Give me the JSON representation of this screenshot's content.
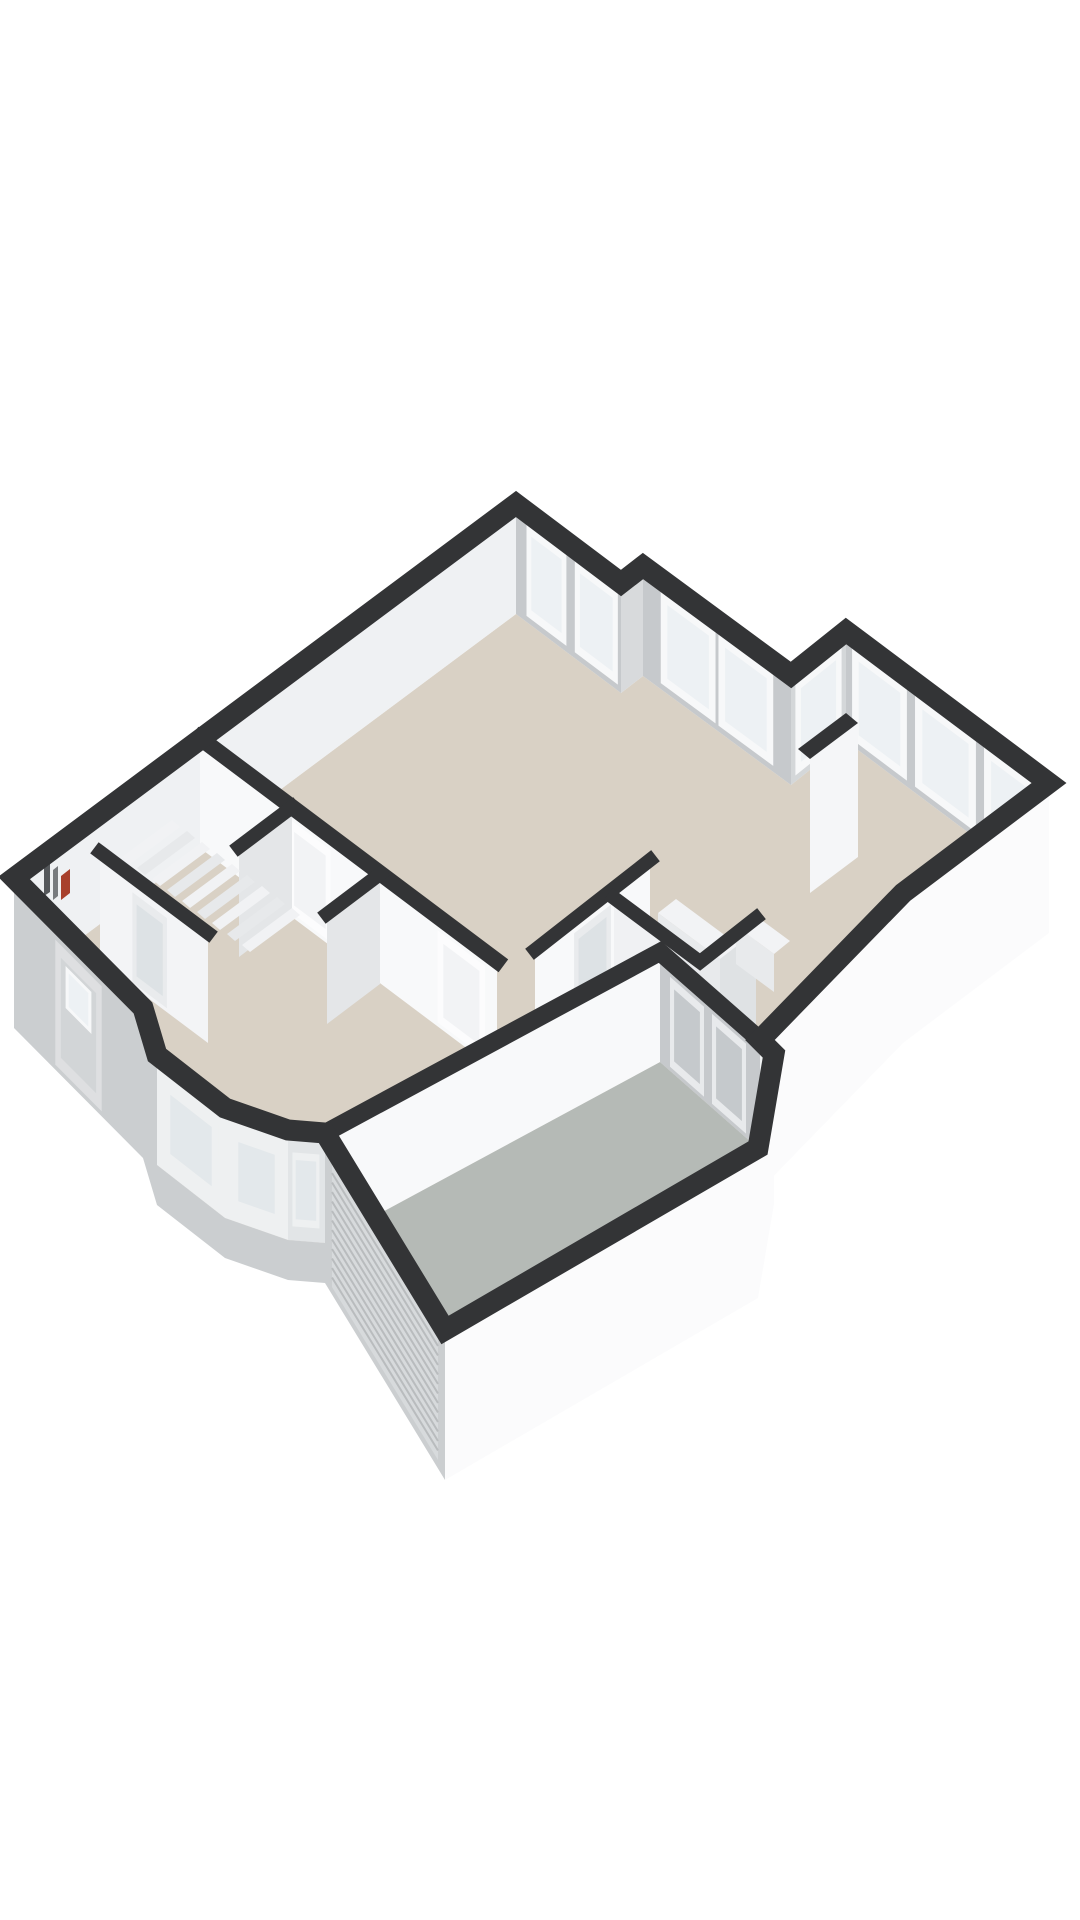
{
  "meta": {
    "canvas_width": 1080,
    "canvas_height": 1920,
    "description_name": "isometric-3d-floorplan-render"
  },
  "colors": {
    "bg": "#ffffff",
    "cap": "#333436",
    "floor_beige": "#d9d1c5",
    "floor_gray": "#b5bab6",
    "inner_light": "#eff1f3",
    "inner_gray": "#c6c9cc",
    "inner_mid": "#d8dadc",
    "wing_end": "#d4d7d9",
    "ext_bright": "#fbfbfc",
    "ext_gray": "#cbced0",
    "ext_step": "#eff1f2",
    "wall_bright": "#f8f9fa",
    "wall_soft": "#f3f4f6",
    "wall_return": "#e4e6e8",
    "wall_shade": "#dfe2e4",
    "wall_midtone": "#f0f1f3",
    "frame_white": "#f7f8f9",
    "glass": "#edf1f4",
    "glass_dim": "#e3e8eb",
    "bay_frame": "#eef0f1",
    "bay_glass": "#e2e5e7",
    "door_leaf": "#dedfe1",
    "door_panel": "#d2d5d7",
    "door_gray_frame": "#e8eaec",
    "door_gray": "#c5c9cc",
    "glazed_frame": "#e9ebed",
    "glazed_glass": "#dde2e5",
    "white_door": "#fcfcfd",
    "white_door_panel": "#f2f3f5",
    "tread_a": "#f1f2f4",
    "tread_b": "#e7e9eb",
    "chimney": "#f5f6f8",
    "box_top": "#f2f3f5",
    "box_face": "#e8eaec",
    "roller": "#d7dadc",
    "roller_line": "#b9bcbe",
    "heater_red": "#a8402c",
    "meter_dark": "#55585b",
    "meter_mid": "#787b7e"
  },
  "floorplan": {
    "shapes": [
      {
        "name": "floor-main-beige",
        "kind": "polygon",
        "fill": "$floor_beige",
        "points": "516,614 621,693 643,676 791,785 846,741 1049,893 903,1003 760,1150 660,1062 325,1243 288,1240 225,1218 157,1165 143,1118 14,988"
      },
      {
        "name": "floor-garage-gray",
        "kind": "polygon",
        "fill": "$floor_gray",
        "points": "325,1243 660,1062 760,1150 758,1258 445,1440"
      },
      {
        "name": "wall-nw-facade-inner-face",
        "kind": "polygon",
        "fill": "$inner_light",
        "points": "516,504 14,878 14,988 516,614"
      },
      {
        "name": "wall-ne-living-inner-face",
        "kind": "polygon",
        "fill": "$inner_gray",
        "points": "516,504 621,583 621,693 516,614"
      },
      {
        "name": "window-living-1",
        "kind": "window",
        "wall": [
          516,
          504,
          621,
          583
        ],
        "a": 0.1,
        "b": 0.48,
        "t": 12,
        "m": 104,
        "frame": "$frame_white",
        "glass": "$glass"
      },
      {
        "name": "window-living-2",
        "kind": "window",
        "wall": [
          516,
          504,
          621,
          583
        ],
        "a": 0.56,
        "b": 0.97,
        "t": 12,
        "m": 104,
        "frame": "$frame_white",
        "glass": "$glass"
      },
      {
        "name": "wall-notch-face",
        "kind": "polygon",
        "fill": "$inner_mid",
        "points": "621,583 643,566 643,676 621,693"
      },
      {
        "name": "wall-french-facade-face",
        "kind": "polygon",
        "fill": "$inner_gray",
        "points": "643,566 791,675 791,785 643,676"
      },
      {
        "name": "window-french-door-left",
        "kind": "window",
        "wall": [
          643,
          566,
          791,
          675
        ],
        "a": 0.12,
        "b": 0.49,
        "t": 12,
        "m": 104,
        "frame": "$frame_white",
        "glass": "$glass"
      },
      {
        "name": "window-french-door-right",
        "kind": "window",
        "wall": [
          643,
          566,
          791,
          675
        ],
        "a": 0.51,
        "b": 0.88,
        "t": 12,
        "m": 104,
        "frame": "$frame_white",
        "glass": "$glass"
      },
      {
        "name": "wall-wing-nw-end-face",
        "kind": "polygon",
        "fill": "$wing_end",
        "points": "791,675 846,631 846,741 791,785"
      },
      {
        "name": "window-wing-end",
        "kind": "window",
        "wall": [
          791,
          675,
          846,
          631
        ],
        "a": 0.08,
        "b": 0.92,
        "t": 12,
        "m": 104,
        "frame": "$frame_white",
        "glass": "$glass"
      },
      {
        "name": "wall-wing-ne-facade-face",
        "kind": "polygon",
        "fill": "$inner_gray",
        "points": "846,631 1049,783 1049,893 846,741"
      },
      {
        "name": "window-wing-1",
        "kind": "window",
        "wall": [
          846,
          631,
          1049,
          783
        ],
        "a": 0.03,
        "b": 0.3,
        "t": 12,
        "m": 104,
        "frame": "$frame_white",
        "glass": "$glass"
      },
      {
        "name": "window-wing-french",
        "kind": "window",
        "wall": [
          846,
          631,
          1049,
          783
        ],
        "a": 0.34,
        "b": 0.64,
        "t": 12,
        "m": 104,
        "frame": "$frame_white",
        "glass": "$glass"
      },
      {
        "name": "window-wing-3",
        "kind": "window",
        "wall": [
          846,
          631,
          1049,
          783
        ],
        "a": 0.68,
        "b": 0.97,
        "t": 12,
        "m": 104,
        "frame": "$frame_white",
        "glass": "$glass"
      },
      {
        "name": "wall-storage-long-face",
        "kind": "polygon",
        "fill": "$wall_bright",
        "points": "200,738 497,961 497,1071 200,848"
      },
      {
        "name": "door-storage-1",
        "kind": "window",
        "wall": [
          200,
          738,
          497,
          961
        ],
        "a": 0.3,
        "b": 0.44,
        "t": 14,
        "m": 106,
        "frame": "$white_door",
        "glass": "$white_door_panel"
      },
      {
        "name": "door-storage-2",
        "kind": "window",
        "wall": [
          200,
          738,
          497,
          961
        ],
        "a": 0.8,
        "b": 0.96,
        "t": 14,
        "m": 106,
        "frame": "$white_door",
        "glass": "$white_door_panel"
      },
      {
        "name": "wall-storage-return-1",
        "kind": "polygon",
        "fill": "$wall_return",
        "points": "292,807 239,847 239,957 292,917"
      },
      {
        "name": "wall-storage-return-2",
        "kind": "polygon",
        "fill": "$wall_return",
        "points": "380,874 327,914 327,1024 380,984"
      },
      {
        "name": "stair-tread-1",
        "kind": "polygon",
        "fill": "$tread_a",
        "points": "300,915 250,952 242,945 292,908"
      },
      {
        "name": "stair-tread-2",
        "kind": "polygon",
        "fill": "$tread_b",
        "points": "285,904 235,941 227,934 277,897"
      },
      {
        "name": "stair-tread-3",
        "kind": "polygon",
        "fill": "$tread_a",
        "points": "270,893 220,930 212,923 262,886"
      },
      {
        "name": "stair-tread-4",
        "kind": "polygon",
        "fill": "$tread_b",
        "points": "255,882 205,919 197,912 247,875"
      },
      {
        "name": "stair-tread-5",
        "kind": "polygon",
        "fill": "$tread_a",
        "points": "240,871 190,908 182,901 232,864"
      },
      {
        "name": "stair-tread-6",
        "kind": "polygon",
        "fill": "$tread_b",
        "points": "225,860 175,897 167,890 217,853"
      },
      {
        "name": "stair-tread-7",
        "kind": "polygon",
        "fill": "$tread_a",
        "points": "210,849 160,886 152,879 202,842"
      },
      {
        "name": "stair-tread-8",
        "kind": "polygon",
        "fill": "$tread_b",
        "points": "195,838 145,875 137,868 187,831"
      },
      {
        "name": "stair-tread-9",
        "kind": "polygon",
        "fill": "$tread_a",
        "points": "180,827 130,864 122,857 172,820"
      },
      {
        "name": "wall-entry-vestibule-face",
        "kind": "polygon",
        "fill": "$wall_soft",
        "points": "100,852 208,933 208,1043 100,962"
      },
      {
        "name": "door-entry-glazed",
        "kind": "window",
        "wall": [
          100,
          852,
          208,
          933
        ],
        "a": 0.3,
        "b": 0.62,
        "t": 16,
        "m": 106,
        "frame": "$glazed_frame",
        "glass": "$glazed_glass"
      },
      {
        "name": "wall-hall-divider-face",
        "kind": "polygon",
        "fill": "$wall_bright",
        "points": "535,950 650,860 650,970 535,1060"
      },
      {
        "name": "door-hall-glazed",
        "kind": "window",
        "wall": [
          535,
          950,
          650,
          860
        ],
        "a": 0.34,
        "b": 0.66,
        "t": 14,
        "m": 104,
        "frame": "$glazed_frame",
        "glass": "$glazed_glass"
      },
      {
        "name": "wall-wc-a-face",
        "kind": "polygon",
        "fill": "$wall_midtone",
        "points": "614,898 700,962 700,1072 614,1008"
      },
      {
        "name": "wall-wc-b-face",
        "kind": "polygon",
        "fill": "$wall_shade",
        "points": "700,962 756,918 756,1028 700,1072"
      },
      {
        "name": "chimney-face",
        "kind": "polygon",
        "fill": "$chimney",
        "points": "810,759 858,723 858,857 810,893"
      },
      {
        "name": "chimney-cap",
        "kind": "polygon",
        "fill": "$cap",
        "points": "798,749 846,713 858,723 810,759"
      },
      {
        "name": "kitchen-box-a-top",
        "kind": "polygon",
        "fill": "$box_top",
        "points": "676,899 738,945 720,959 658,913"
      },
      {
        "name": "kitchen-box-a-face",
        "kind": "polygon",
        "fill": "$box_face",
        "points": "658,913 720,959 720,1000 658,954"
      },
      {
        "name": "kitchen-box-b-top",
        "kind": "polygon",
        "fill": "$box_top",
        "points": "752,913 790,941 774,954 736,926"
      },
      {
        "name": "kitchen-box-b-face",
        "kind": "polygon",
        "fill": "$box_face",
        "points": "736,926 774,954 774,992 736,964"
      },
      {
        "name": "meter-closet-heater-red",
        "kind": "polygon",
        "fill": "$heater_red",
        "points": "61,876 70,869 70,893 61,900"
      },
      {
        "name": "meter-closet-slat-dark",
        "kind": "polygon",
        "fill": "$meter_dark",
        "points": "44,866 50,862 50,892 44,896"
      },
      {
        "name": "meter-closet-slat-mid",
        "kind": "polygon",
        "fill": "$meter_mid",
        "points": "53,870 58,866 58,896 53,900"
      },
      {
        "name": "garage-nw-wall-inner-face",
        "kind": "polygon",
        "fill": "$wall_bright",
        "points": "325,1133 660,952 660,1062 325,1243"
      },
      {
        "name": "garage-ne-wall-inner-face",
        "kind": "polygon",
        "fill": "$inner_gray",
        "points": "660,952 760,1040 760,1150 660,1062"
      },
      {
        "name": "garage-back-door-1",
        "kind": "window",
        "wall": [
          660,
          952,
          760,
          1040
        ],
        "a": 0.1,
        "b": 0.44,
        "t": 16,
        "m": 106,
        "frame": "$door_gray_frame",
        "glass": "$door_gray"
      },
      {
        "name": "garage-back-door-2",
        "kind": "window",
        "wall": [
          660,
          952,
          760,
          1040
        ],
        "a": 0.52,
        "b": 0.86,
        "t": 16,
        "m": 106,
        "frame": "$door_gray_frame",
        "glass": "$door_gray"
      },
      {
        "name": "wing-se-exterior-face",
        "kind": "polygon",
        "fill": "$ext_bright",
        "points": "1049,783 903,893 903,1043 1049,933"
      },
      {
        "name": "kitchen-se-exterior-face",
        "kind": "polygon",
        "fill": "$ext_bright",
        "points": "903,893 760,1040 760,1190 903,1043"
      },
      {
        "name": "step-exterior-face-a",
        "kind": "polygon",
        "fill": "$ext_step",
        "points": "760,1040 774,1054 774,1204 760,1190"
      },
      {
        "name": "step-exterior-face-b",
        "kind": "polygon",
        "fill": "$ext_bright",
        "points": "774,1054 758,1148 758,1298 774,1204"
      },
      {
        "name": "garage-se-exterior-face",
        "kind": "polygon",
        "fill": "$ext_bright",
        "points": "758,1148 445,1330 445,1480 758,1298"
      },
      {
        "name": "garage-sw-exterior-face",
        "kind": "polygon",
        "fill": "$ext_gray",
        "points": "445,1330 325,1133 325,1283 445,1480"
      },
      {
        "name": "garage-roller-door",
        "kind": "polygon",
        "fill": "$roller",
        "points": "438,1336 332,1163 332,1287 438,1460"
      },
      {
        "name": "garage-roller-door-slats",
        "kind": "slats",
        "p1": [
          438,
          1346
        ],
        "p2": [
          332,
          1173
        ],
        "n": 12,
        "dy": 9.5,
        "stroke": "$roller_line",
        "width": 2
      },
      {
        "name": "front-facade-exterior-face",
        "kind": "polygon",
        "fill": "$ext_gray",
        "points": "14,878 143,1008 143,1158 14,1028"
      },
      {
        "name": "front-door",
        "kind": "window",
        "wall": [
          14,
          878,
          143,
          1008
        ],
        "a": 0.32,
        "b": 0.68,
        "t": 20,
        "m": 145,
        "frame": "$door_leaf",
        "glass": "$door_panel"
      },
      {
        "name": "front-door-window",
        "kind": "window",
        "wall": [
          14,
          878,
          143,
          1008
        ],
        "a": 0.4,
        "b": 0.6,
        "t": 36,
        "m": 78,
        "frame": "$frame_white",
        "glass": "$glass"
      },
      {
        "name": "bay-left-return-face",
        "kind": "polygon",
        "fill": "$ext_gray",
        "points": "143,1008 157,1055 157,1185 143,1138"
      },
      {
        "name": "bay-left-face",
        "kind": "polygon",
        "fill": "$bay_frame",
        "points": "157,1055 225,1108 225,1218 157,1165"
      },
      {
        "name": "bay-window-left",
        "kind": "window",
        "wall": [
          157,
          1055,
          225,
          1108
        ],
        "a": 0.1,
        "b": 0.9,
        "t": 22,
        "m": 96,
        "frame": "$bay_frame",
        "glass": "$glass_dim"
      },
      {
        "name": "bay-front-face",
        "kind": "polygon",
        "fill": "$bay_frame",
        "points": "225,1108 288,1130 288,1240 225,1218"
      },
      {
        "name": "bay-window-front",
        "kind": "window",
        "wall": [
          225,
          1108,
          288,
          1130
        ],
        "a": 0.12,
        "b": 0.88,
        "t": 22,
        "m": 96,
        "frame": "$bay_frame",
        "glass": "$glass_dim"
      },
      {
        "name": "bay-right-face",
        "kind": "polygon",
        "fill": "$bay_glass",
        "points": "288,1130 325,1133 325,1243 288,1240"
      },
      {
        "name": "bay-window-right",
        "kind": "window",
        "wall": [
          288,
          1130,
          325,
          1133
        ],
        "a": 0.12,
        "b": 0.85,
        "t": 22,
        "m": 96,
        "frame": "$bay_frame",
        "glass": "$glass_dim"
      },
      {
        "name": "bay-lower-band",
        "kind": "polygon",
        "fill": "$ext_gray",
        "points": "143,1118 157,1165 225,1218 288,1240 325,1243 325,1283 288,1280 225,1258 157,1205 143,1158"
      },
      {
        "name": "cap-storage-long-wall",
        "kind": "path",
        "stroke": "$cap",
        "width": 16,
        "d": "M200,738 L497,961"
      },
      {
        "name": "cap-storage-return-1",
        "kind": "path",
        "stroke": "$cap",
        "width": 14,
        "d": "M292,807 L239,847"
      },
      {
        "name": "cap-storage-return-2",
        "kind": "path",
        "stroke": "$cap",
        "width": 14,
        "d": "M380,874 L327,914"
      },
      {
        "name": "cap-entry-vestibule",
        "kind": "path",
        "stroke": "$cap",
        "width": 14,
        "d": "M100,852 L208,933"
      },
      {
        "name": "cap-hall-divider",
        "kind": "path",
        "stroke": "$cap",
        "width": 14,
        "d": "M535,950 L650,860"
      },
      {
        "name": "cap-wc-walls",
        "kind": "path",
        "stroke": "$cap",
        "width": 14,
        "d": "M614,898 L700,962 L756,918"
      },
      {
        "name": "cap-garage-inner-walls",
        "kind": "path",
        "stroke": "$cap",
        "width": 18,
        "d": "M325,1133 L660,952 L760,1040"
      },
      {
        "name": "cap-outer-walls",
        "kind": "path",
        "stroke": "$cap",
        "width": 21,
        "d": "M516,504 L621,583 L643,566 L791,675 L846,631 L1049,783 L903,893 L760,1040 L774,1054 L758,1148 L445,1330 L325,1133 L288,1130 L225,1108 L157,1055 L143,1008 L14,878 Z"
      }
    ]
  }
}
